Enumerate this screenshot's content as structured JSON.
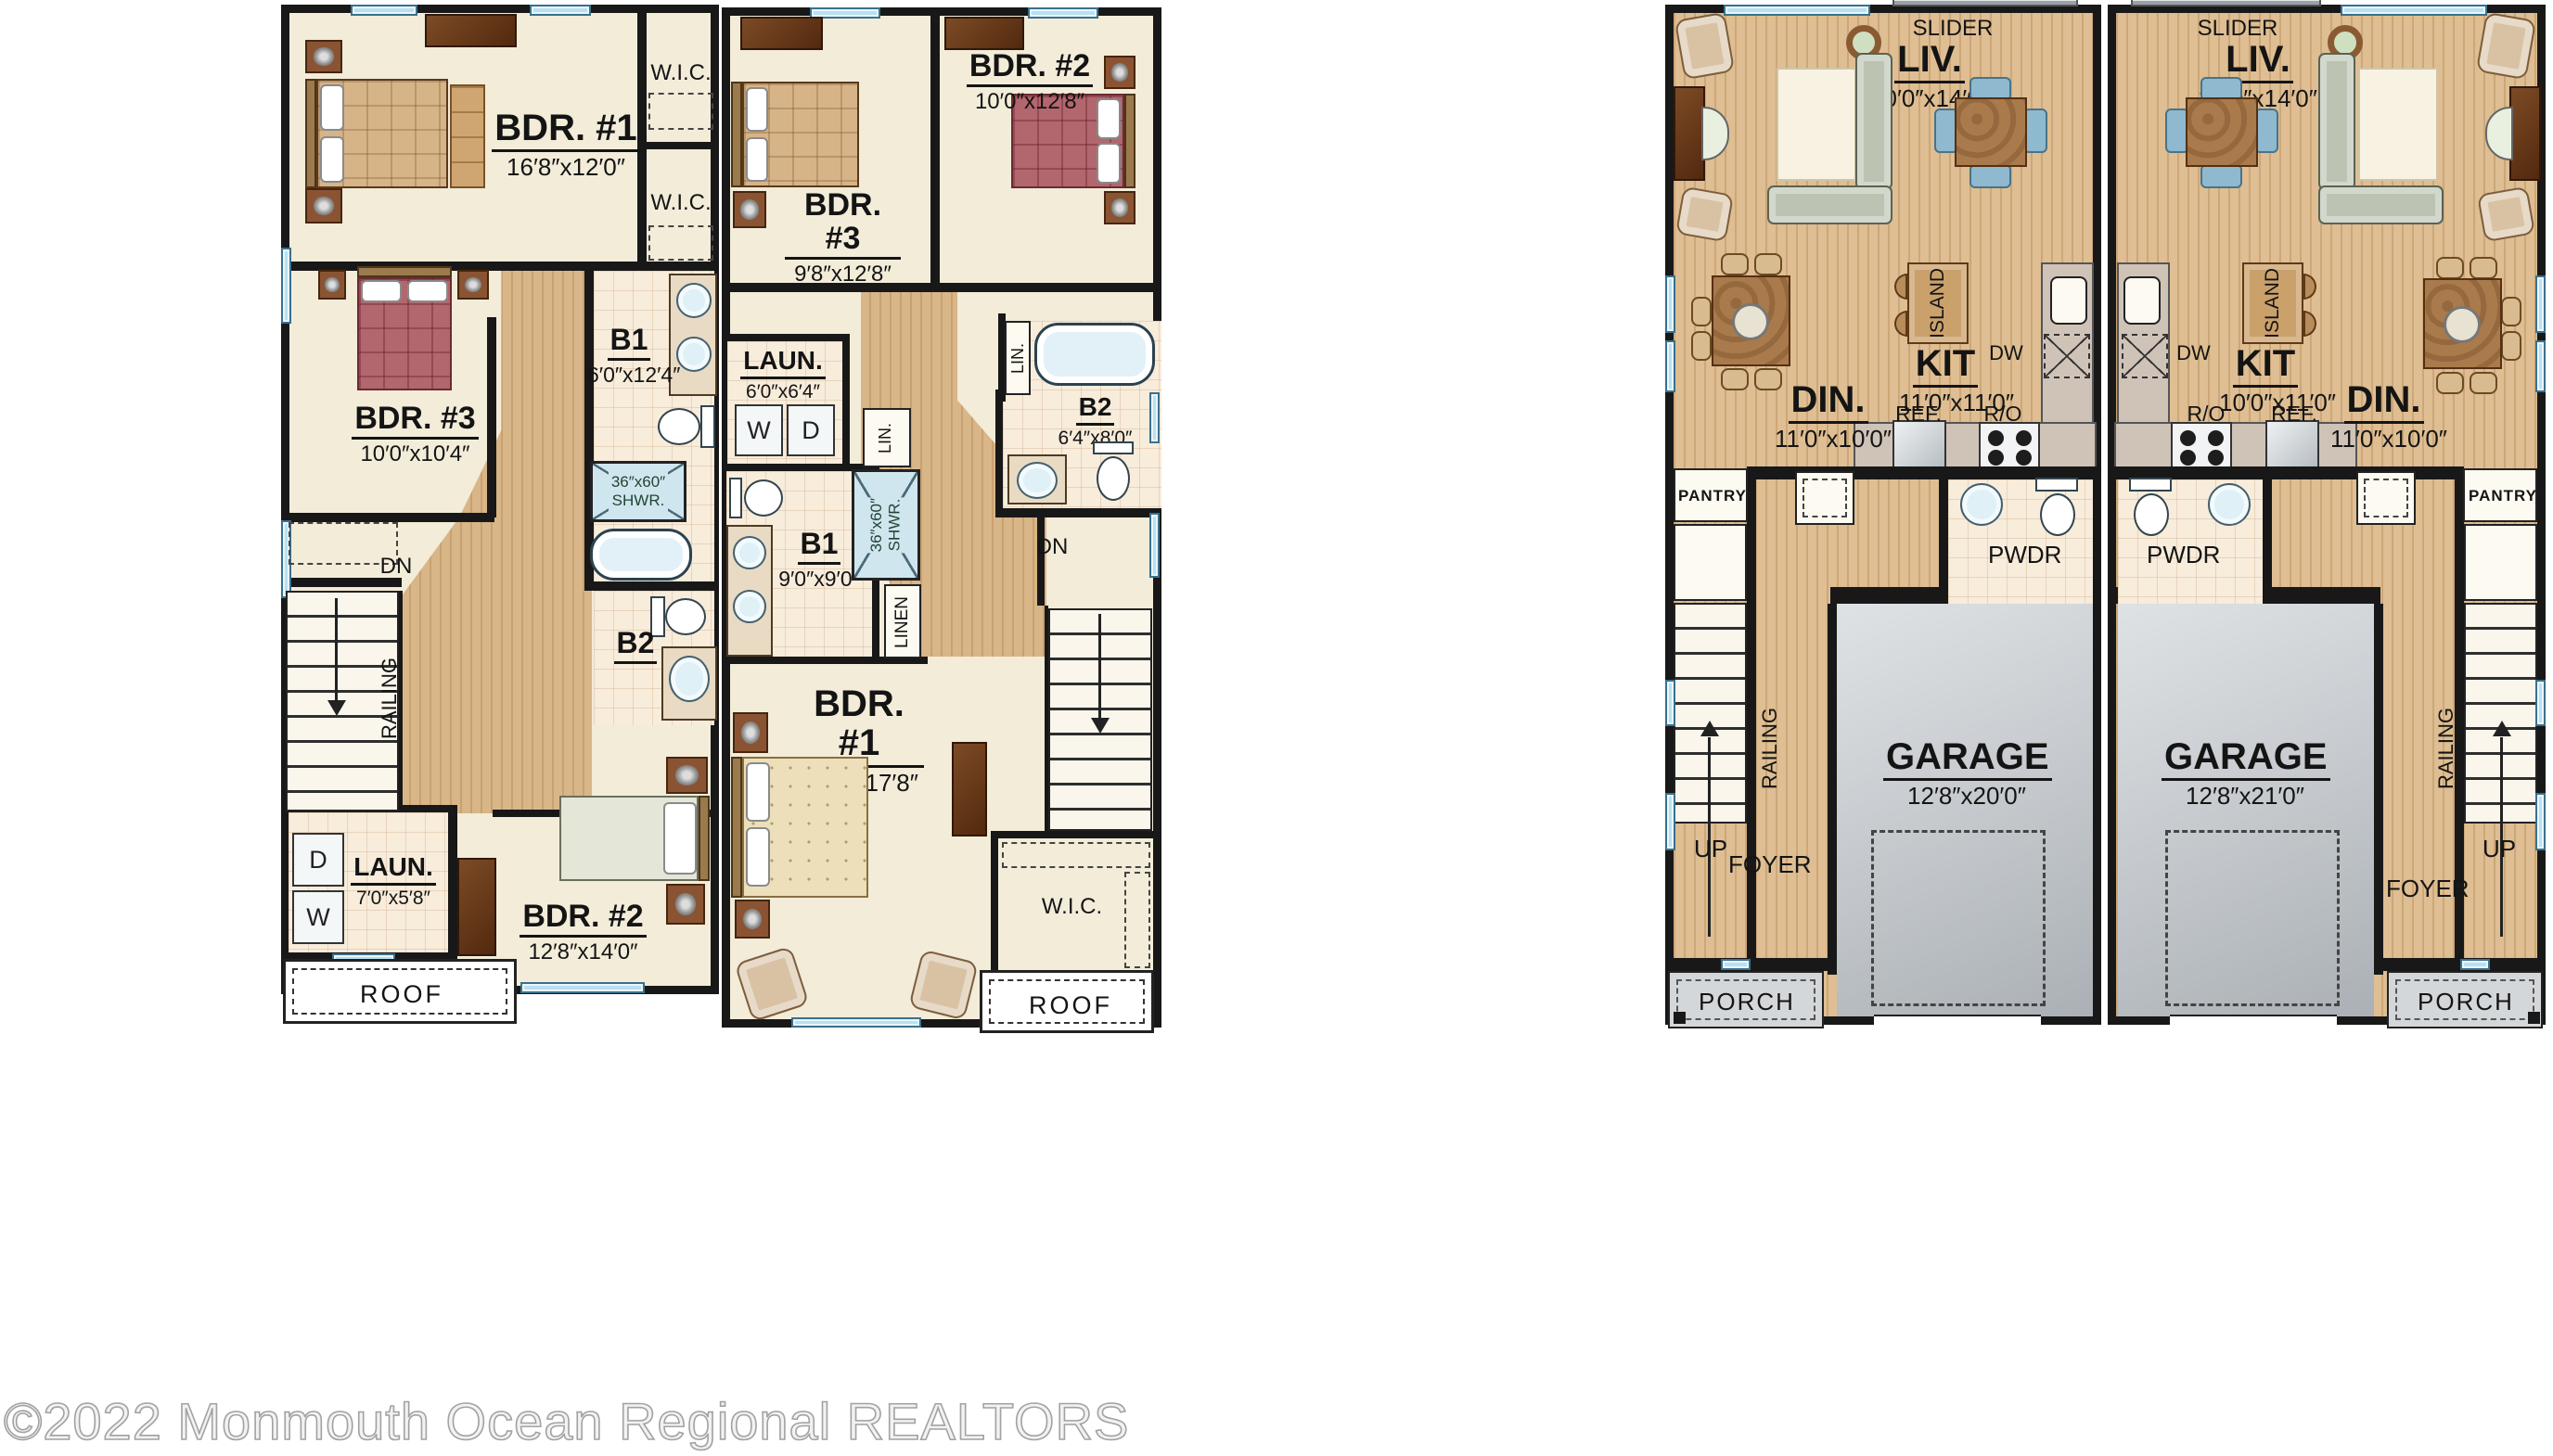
{
  "watermark": "©2022 Monmouth Ocean Regional REALTORS",
  "colors": {
    "wall": "#181818",
    "floor_cream": "#f2ecd9",
    "wood_floor": "#cda778",
    "bath_tile": "#f8ecdb",
    "garage_gray": "#c8ccd0",
    "window_blue": "#b9e0f2",
    "porch_gray": "#d4d7d9",
    "accent_maroon": "#b2666d"
  },
  "units": {
    "a": {
      "bdr1_name": "BDR. #1",
      "bdr1_dim": "16′8″x12′0″",
      "wic1": "W.I.C.",
      "wic2": "W.I.C.",
      "bdr3_name": "BDR. #3",
      "bdr3_dim": "10′0″x10′4″",
      "b1_name": "B1",
      "b1_dim": "6′0″x12′4″",
      "shwr1": "36″x60″",
      "shwr2": "SHWR.",
      "b2": "B2",
      "dn": "DN",
      "railing": "RAILING",
      "laun_name": "LAUN.",
      "laun_dim": "7′0″x5′8″",
      "w": "W",
      "d": "D",
      "bdr2_name": "BDR. #2",
      "bdr2_dim": "12′8″x14′0″",
      "roof": "ROOF"
    },
    "b": {
      "bdr3_name": "BDR. #3",
      "bdr3_dim": "9′8″x12′8″",
      "bdr2_name": "BDR. #2",
      "bdr2_dim": "10′0″x12′8″",
      "laun_name": "LAUN.",
      "laun_dim": "6′0″x6′4″",
      "w": "W",
      "d": "D",
      "lin1": "LIN.",
      "lin2": "LIN.",
      "b2_name": "B2",
      "b2_dim": "6′4″x8′0″",
      "b1_name": "B1",
      "b1_dim": "9′0″x9′0″",
      "shwr1": "36″x60″",
      "shwr2": "SHWR.",
      "linen": "LINEN",
      "dn": "DN",
      "bdr1_name": "BDR. #1",
      "bdr1_dim": "12′8″x17′8″",
      "wic": "W.I.C.",
      "roof": "ROOF"
    },
    "c": {
      "slider": "SLIDER",
      "liv_name": "LIV.",
      "liv_dim": "20′0″x14′0″",
      "din_name": "DIN.",
      "din_dim": "11′0″x10′0″",
      "kit_name": "KIT",
      "kit_dim": "11′0″x11′0″",
      "island": "ISLAND",
      "dw": "DW",
      "ref": "REF.",
      "ro": "R/O",
      "pantry": "PANTRY",
      "pwdr": "PWDR",
      "railing": "RAILING",
      "up": "UP",
      "foyer": "FOYER",
      "garage_name": "GARAGE",
      "garage_dim": "12′8″x20′0″",
      "porch": "PORCH"
    },
    "d": {
      "slider": "SLIDER",
      "liv_name": "LIV.",
      "liv_dim": "20′0″x14′0″",
      "kit_name": "KIT",
      "kit_dim": "10′0″x11′0″",
      "din_name": "DIN.",
      "din_dim": "11′0″x10′0″",
      "island": "ISLAND",
      "dw": "DW",
      "ref": "REF.",
      "ro": "R/O",
      "pantry": "PANTRY",
      "pwdr": "PWDR",
      "railing": "RAILING",
      "up": "UP",
      "foyer": "FOYER",
      "garage_name": "GARAGE",
      "garage_dim": "12′8″x21′0″",
      "porch": "PORCH"
    }
  }
}
